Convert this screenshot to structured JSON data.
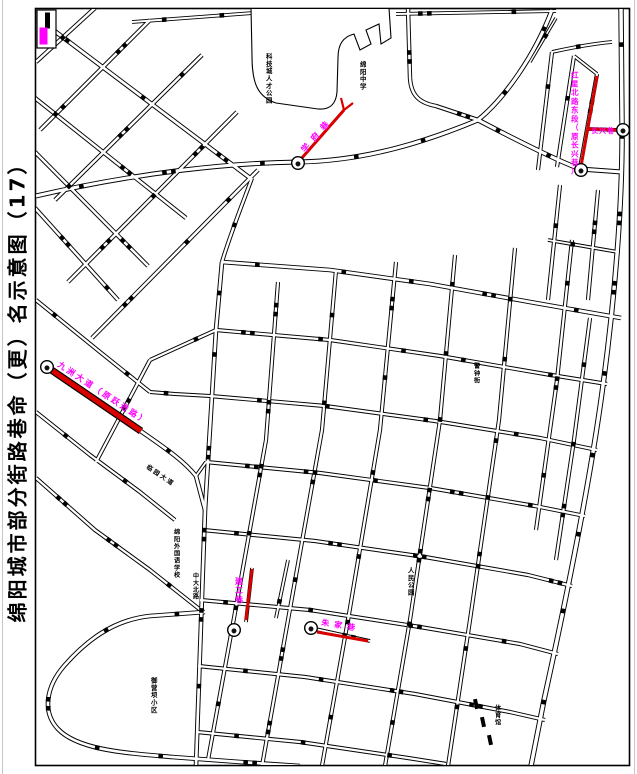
{
  "title": "绵阳城市部分街路巷命（更）名示意图（17）",
  "legend": {
    "renamed_swatch_color": "#FF00FF",
    "road_swatch_color": "#000000"
  },
  "highlighted_streets": [
    {
      "id": "top-right",
      "label": "红星北路东段（原长兴巷）"
    },
    {
      "id": "top-right-branch",
      "label": "长兴巷"
    },
    {
      "id": "top-middle",
      "label": "学府巷"
    },
    {
      "id": "left-middle",
      "label": "九洲大道（原跃进路）"
    },
    {
      "id": "bottom-left",
      "label": "建工巷"
    },
    {
      "id": "bottom-middle",
      "label": "朱家巷"
    }
  ],
  "area_labels": [
    {
      "id": "campus",
      "text": "科技城人才公园"
    },
    {
      "id": "school-north",
      "text": "绵阳中学"
    },
    {
      "id": "peoples-park",
      "text": "人民公园"
    },
    {
      "id": "foreign-school",
      "text": "绵阳外国语学校"
    },
    {
      "id": "zhongda-road",
      "text": "中大北路"
    },
    {
      "id": "yuyingba-block",
      "text": "御营坝小区"
    },
    {
      "id": "jingzhong-street",
      "text": "警钟街"
    },
    {
      "id": "gymnasium",
      "text": "体育馆"
    },
    {
      "id": "linyuan-avenue",
      "text": "临园大道"
    }
  ],
  "markers": [
    {
      "id": "marker-top-middle",
      "glyph": "●"
    },
    {
      "id": "marker-top-right",
      "glyph": "●"
    },
    {
      "id": "marker-branch-end",
      "glyph": "●"
    },
    {
      "id": "marker-left-middle",
      "glyph": "●"
    },
    {
      "id": "marker-bottom-left",
      "glyph": "●"
    },
    {
      "id": "marker-bottom-middle",
      "glyph": "●"
    }
  ],
  "colors": {
    "highlight_road": "#D90000",
    "label_magenta": "#FF00FF",
    "road_casing": "#000000",
    "road_fill": "#FFFFFF",
    "page_edge": "#C6C6C6"
  }
}
